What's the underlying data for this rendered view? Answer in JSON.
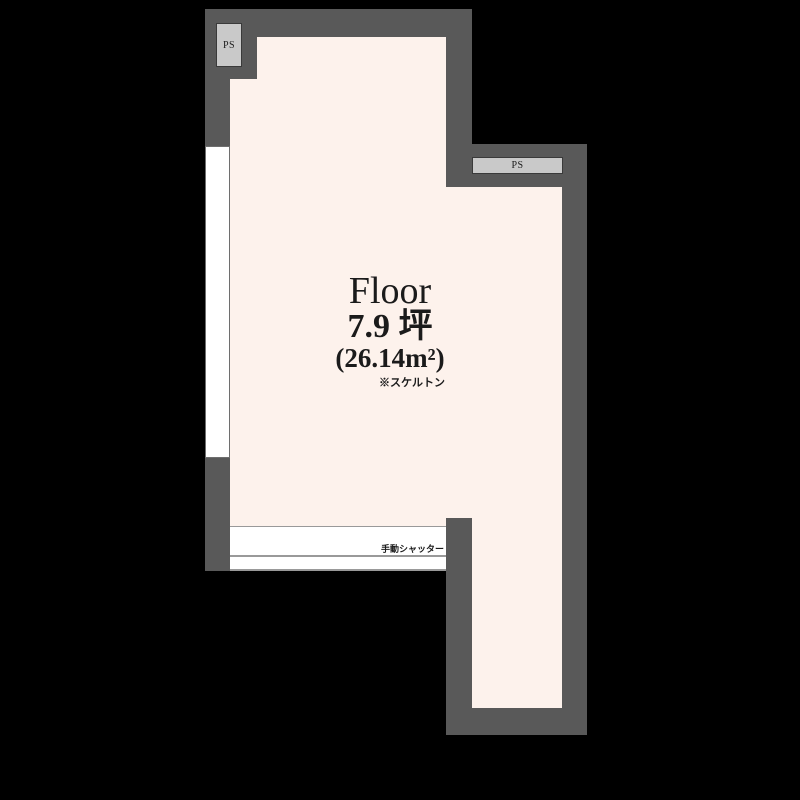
{
  "floorplan": {
    "colors": {
      "background": "#000000",
      "wall": "#595959",
      "floor": "#FDF2EC",
      "ps_fill": "#C9C9C9",
      "ps_border": "#3A3A3A",
      "opening": "#FFFFFF",
      "opening_line": "#999999",
      "text": "#1B1B1B"
    },
    "room": {
      "name": "Floor",
      "area_tsubo": "7.9 坪",
      "area_sqm": "(26.14m²)",
      "note": "※スケルトン"
    },
    "features": {
      "ps_top_left_label": "PS",
      "ps_right_label": "PS",
      "shutter_label": "手動シャッター"
    }
  }
}
